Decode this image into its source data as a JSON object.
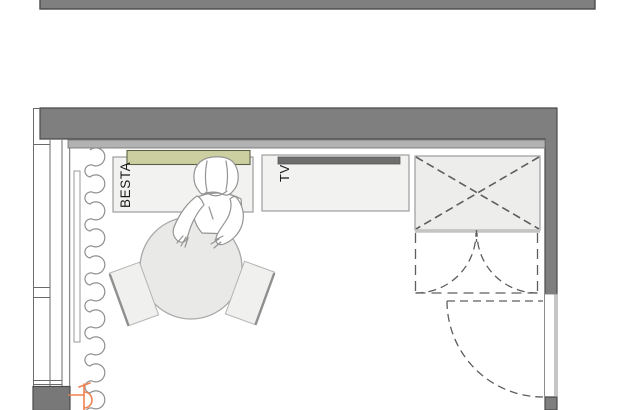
{
  "labels": {
    "besta_cabinet": "BESTA",
    "tv_bench": "TV"
  },
  "colors": {
    "bg": "#ffffff",
    "wall": "#7f7f7f",
    "wallOutline": "#4b4b4b",
    "pier": "#787878",
    "bulkhead": "#b2b2b2",
    "furnitureFill": "#f2f2f0",
    "furnitureLine": "#9c9c9c",
    "shelfGreen": "#ccd0a0",
    "shelfGreenLine": "#5d5f45",
    "tvUnit": "#6e6e6e",
    "dash": "#5e5e5e",
    "curtain": "#8f8f8f",
    "tableFill": "#e9e9e7",
    "outletOrange": "#f08250",
    "text": "#1a1a1a"
  },
  "plan_objects": [
    {
      "name": "neighbor-wall",
      "kind": "wall segment of adjacent room (top edge)"
    },
    {
      "name": "top-wall",
      "kind": "exterior wall"
    },
    {
      "name": "right-wall",
      "kind": "wall with door opening"
    },
    {
      "name": "window",
      "kind": "window in left wall, two sashes"
    },
    {
      "name": "curtain",
      "kind": "scalloped curtain along window"
    },
    {
      "name": "curtain-pelmet",
      "kind": "curtain rail"
    },
    {
      "name": "power-outlet",
      "kind": "orange electrical symbol, bottom left"
    },
    {
      "name": "besta-cabinet",
      "label": "BESTA"
    },
    {
      "name": "wall-shelf",
      "kind": "green shelf above BESTA"
    },
    {
      "name": "tv-bench",
      "label": "TV"
    },
    {
      "name": "tv-screen",
      "kind": "dark bar on TV bench"
    },
    {
      "name": "wardrobe",
      "kind": "crossed box with double-door swing"
    },
    {
      "name": "entry-door",
      "kind": "dashed swing door in right wall"
    },
    {
      "name": "dining-table",
      "kind": "round table"
    },
    {
      "name": "chair-left",
      "kind": "chair"
    },
    {
      "name": "chair-right",
      "kind": "chair"
    },
    {
      "name": "person",
      "kind": "figure leaning over table"
    }
  ]
}
